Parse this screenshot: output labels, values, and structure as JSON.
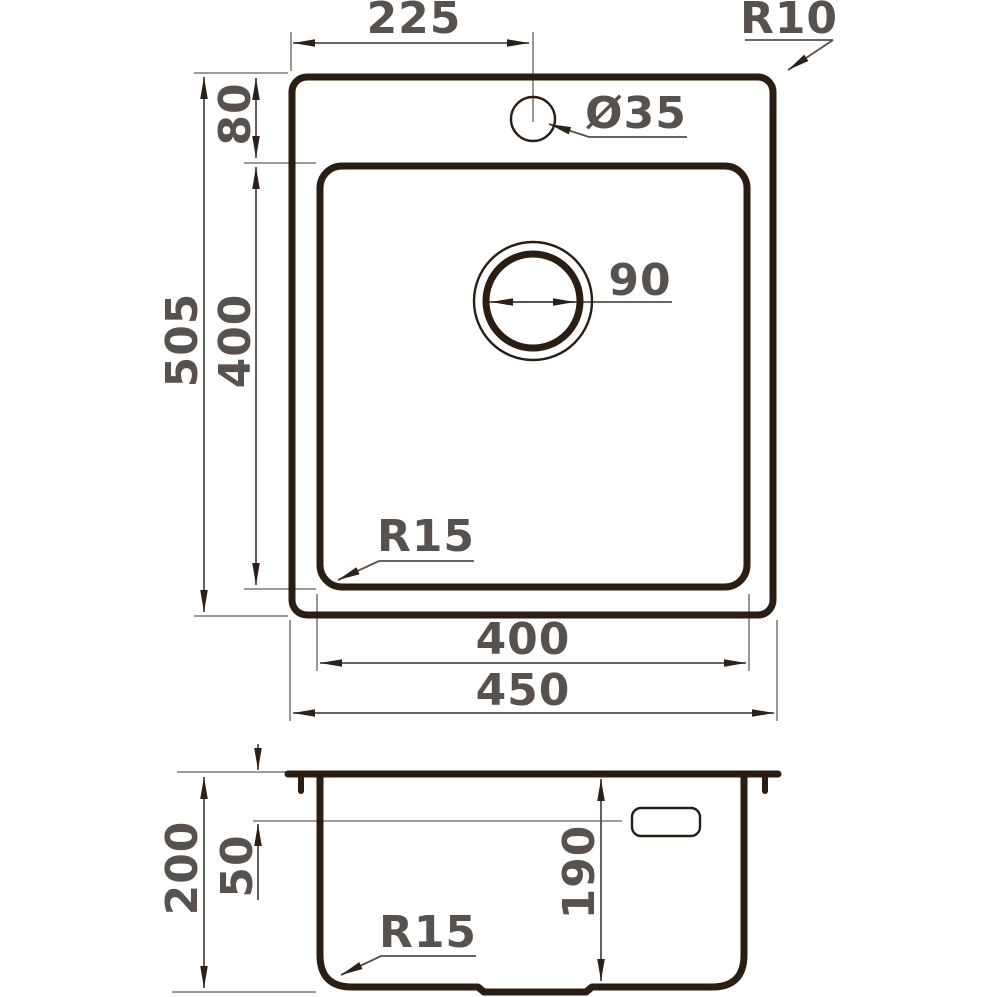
{
  "drawing": {
    "type": "technical-dimension-drawing",
    "subject": "kitchen sink, top view and side section view",
    "units": "mm",
    "colors": {
      "outline": "#2a1d12",
      "dimension_line": "#554f49",
      "extension_line": "#908b86",
      "arrow": "#2b2118",
      "label_text": "#57524d",
      "background": "#ffffff"
    },
    "top_view": {
      "faucet_offset": "225",
      "corner_radius": "R10",
      "rim_to_bowl": "80",
      "faucet_hole_diameter": "Ø35",
      "drain_diameter": "90",
      "overall_length": "505",
      "bowl_length": "400",
      "bowl_corner_radius": "R15",
      "bowl_width": "400",
      "overall_width": "450"
    },
    "side_view": {
      "overall_depth": "200",
      "overflow_offset": "50",
      "bowl_depth": "190",
      "bottom_corner_radius": "R15"
    }
  }
}
